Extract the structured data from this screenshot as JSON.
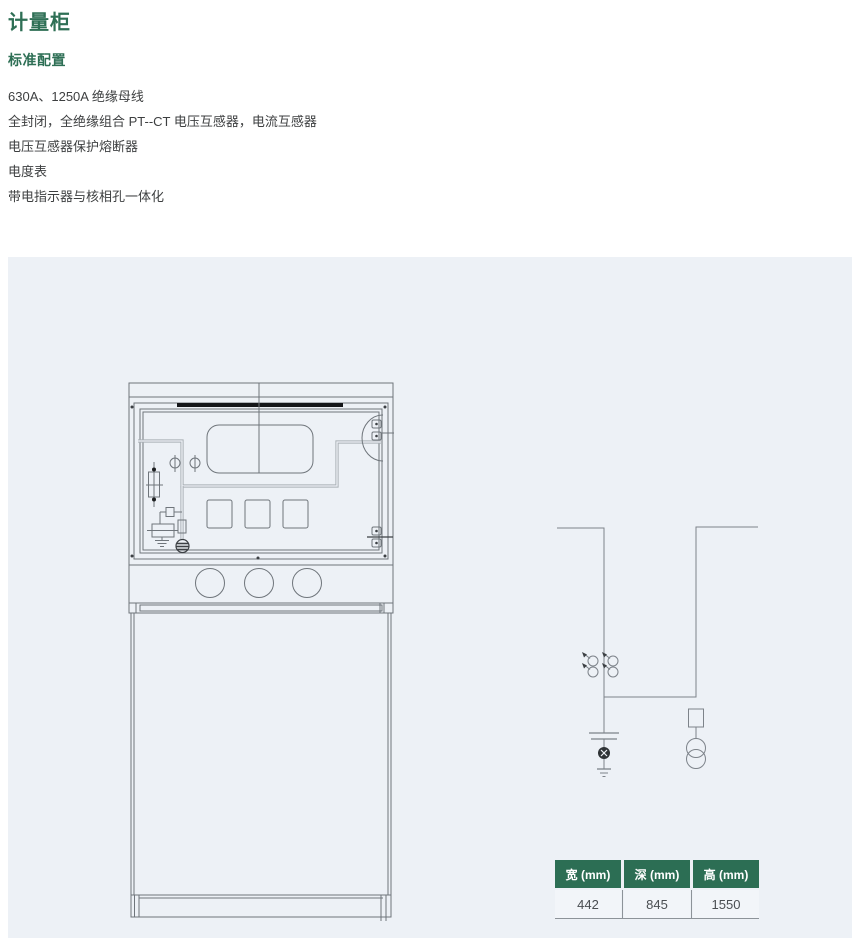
{
  "header": {
    "title": "计量柜",
    "section_title": "标准配置"
  },
  "features": [
    "630A、1250A 绝缘母线",
    "全封闭，全绝缘组合 PT--CT 电压互感器，电流互感器",
    "电压互感器保护熔断器",
    "电度表",
    "带电指示器与核相孔一体化"
  ],
  "dimensions_table": {
    "headers": [
      "宽 (mm)",
      "深 (mm)",
      "高 (mm)"
    ],
    "values": [
      "442",
      "845",
      "1550"
    ]
  },
  "figures": {
    "cabinet_drawing": "cabinet-front-view",
    "circuit_drawing": "single-line-diagram"
  },
  "colors": {
    "accent_green": "#2e6f55",
    "table_header_green": "#2c6e54",
    "panel_background": "#edf1f6",
    "body_text": "#3d3f40",
    "line_gray": "#6f757b"
  }
}
